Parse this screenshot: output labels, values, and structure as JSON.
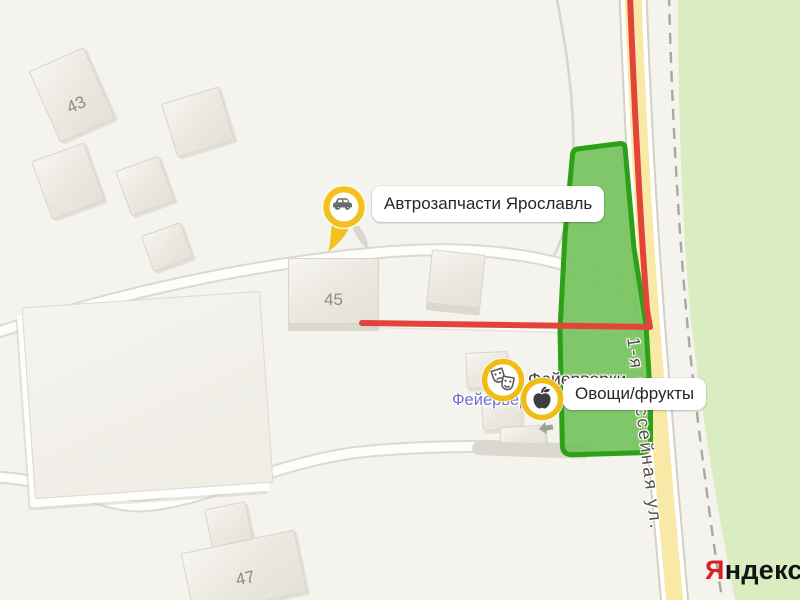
{
  "map": {
    "street_label": "1-я шоссейная ул.",
    "buildings": [
      {
        "number": "43"
      },
      {
        "number": "45"
      },
      {
        "number": "47"
      }
    ],
    "markers": {
      "autoparts": {
        "label": "Автрозапчасти Ярославль",
        "icon": "car-icon"
      },
      "fireworks": {
        "map_label": "Фейерверки",
        "store_label": "Фейерверки",
        "icon": "theater-masks-icon"
      },
      "produce": {
        "label": "Овощи/фрукты",
        "icon": "apple-icon"
      }
    },
    "logo": {
      "first_letter": "Я",
      "rest": "ндекс"
    },
    "colors": {
      "marker_yellow": "#f3c11d",
      "selected_area_fill": "#73c25a",
      "selected_area_border": "#2da019",
      "road_fill": "#f8e9a6",
      "traffic_red": "#e2443b",
      "vegetation_green": "#d9edc0",
      "store_label_blue": "#6e6ecf",
      "logo_red": "#dc1f26"
    }
  }
}
